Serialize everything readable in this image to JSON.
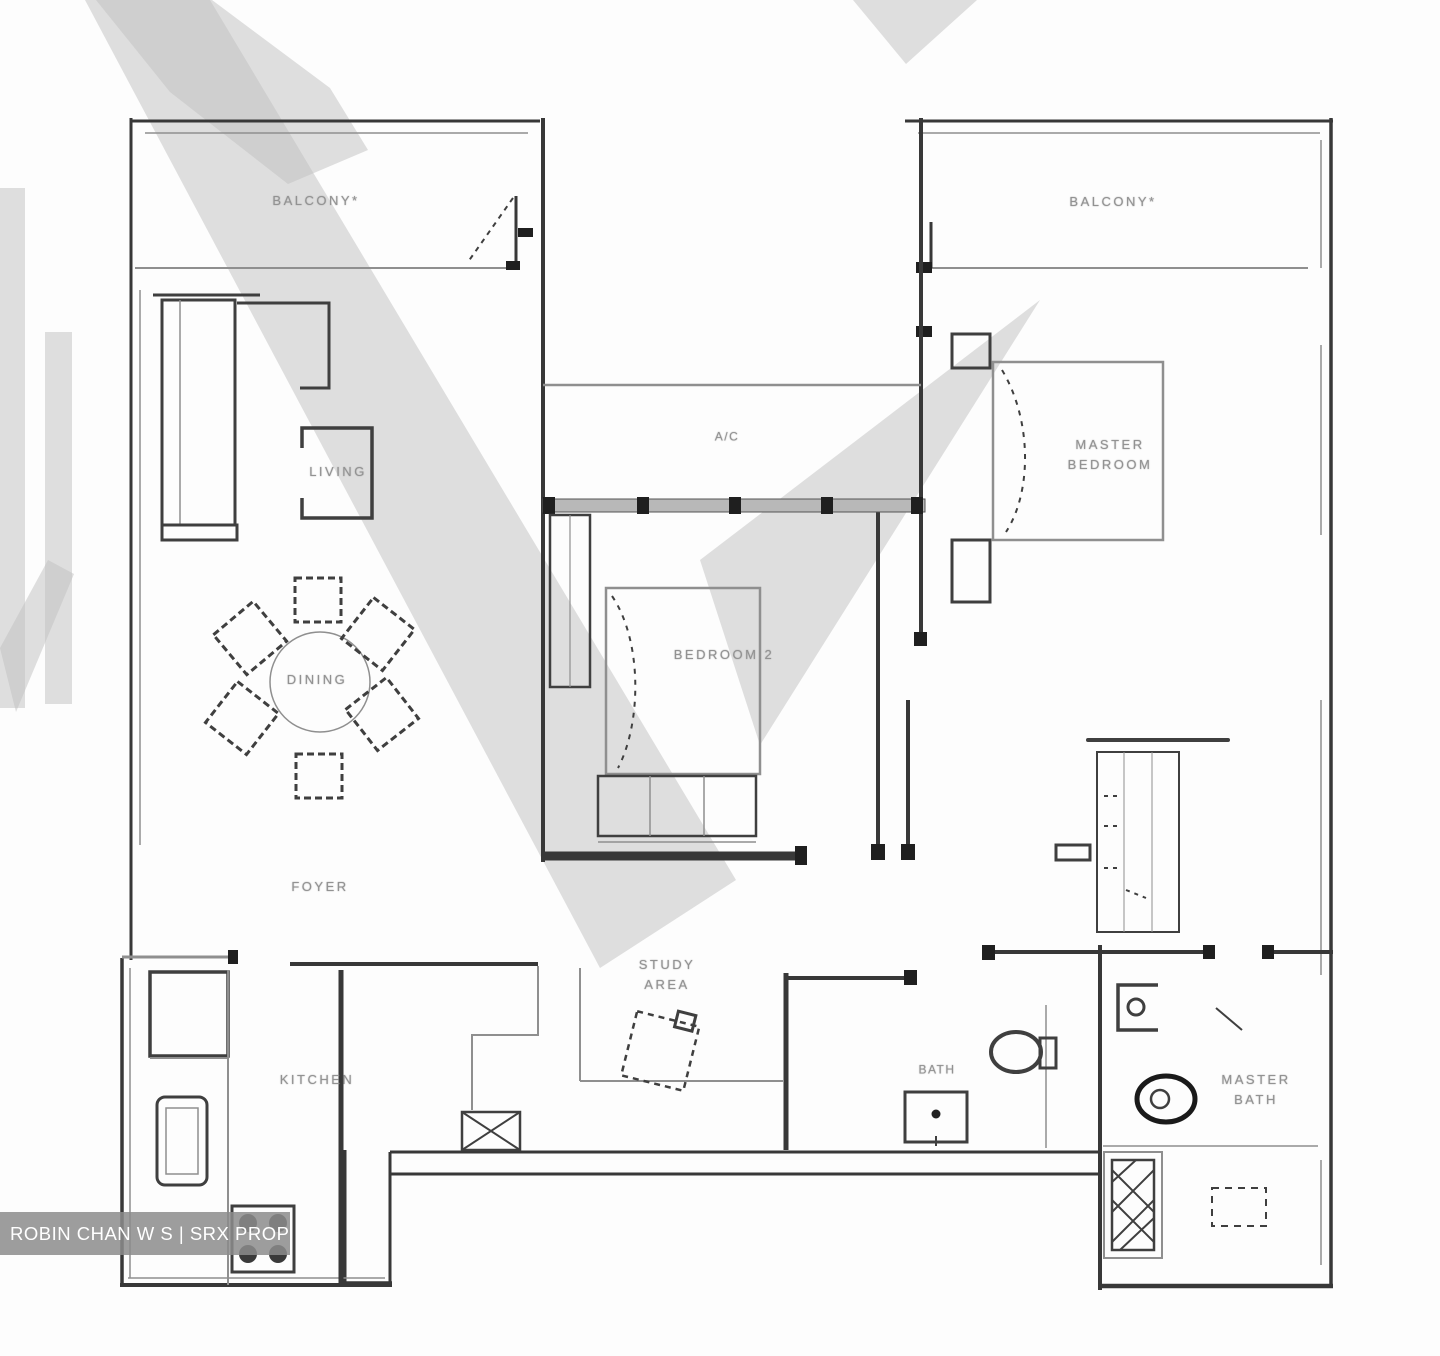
{
  "labels": {
    "balcony_left": "BALCONY*",
    "balcony_right": "BALCONY*",
    "living": "LIVING",
    "dining": "DINING",
    "foyer": "FOYER",
    "kitchen": "KITCHEN",
    "bedroom2": "BEDROOM 2",
    "ac": "A/C",
    "master_bedroom": [
      "MASTER",
      "BEDROOM"
    ],
    "study": [
      "STUDY",
      "AREA"
    ],
    "bath": "BATH",
    "master_bath": [
      "MASTER",
      "BATH"
    ]
  },
  "watermark": {
    "bar_text": "ROBIN CHAN W S | SRX PROPERTY"
  },
  "colors": {
    "wall": "#383838",
    "thin_line": "#8f8f8f",
    "label_text": "#929292",
    "window_band": "#b8b8b8",
    "ghost_watermark": "#c0c0c0",
    "watermark_bar": "rgba(140,140,140,0.85)",
    "watermark_bar_text": "#ffffff"
  }
}
